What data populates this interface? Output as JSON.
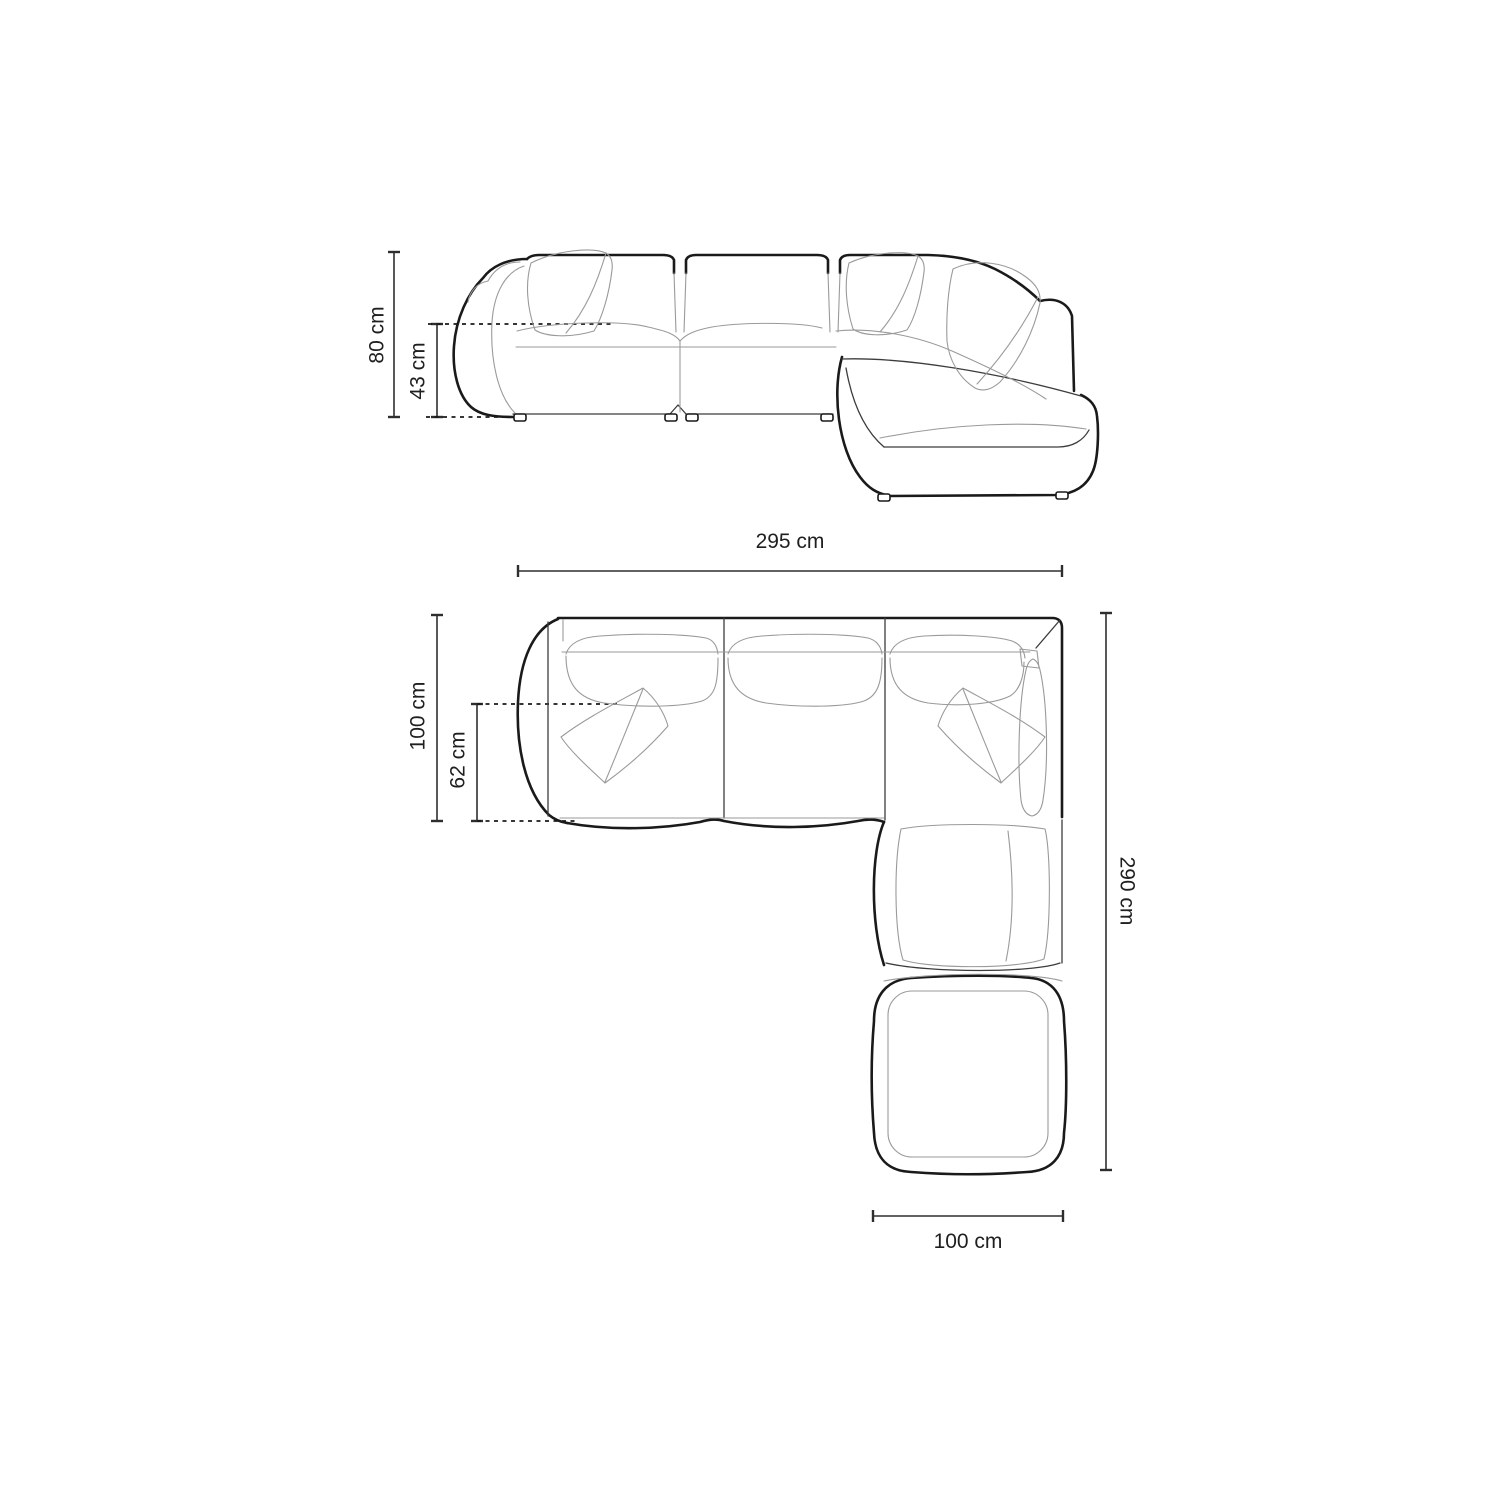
{
  "page": {
    "background": "#ffffff"
  },
  "colors": {
    "outline_bold": "#1a1a1a",
    "outline_thin": "#3c3c3c",
    "detail_gray": "#9a9a9a",
    "dimension_line": "#2e2e2e",
    "label_text": "#1f1f1f"
  },
  "front_view": {
    "name": "front-elevation-of-corner-sofa",
    "dimensions": {
      "overall_height": {
        "value": "80 cm"
      },
      "seat_height": {
        "value": "43 cm"
      }
    }
  },
  "top_view": {
    "name": "top-plan-of-corner-sofa",
    "dimensions": {
      "overall_width": {
        "value": "295 cm"
      },
      "overall_depth": {
        "value": "100 cm"
      },
      "seat_depth": {
        "value": "62 cm"
      },
      "overall_length": {
        "value": "290 cm"
      },
      "chaise_width": {
        "value": "100 cm"
      }
    }
  }
}
